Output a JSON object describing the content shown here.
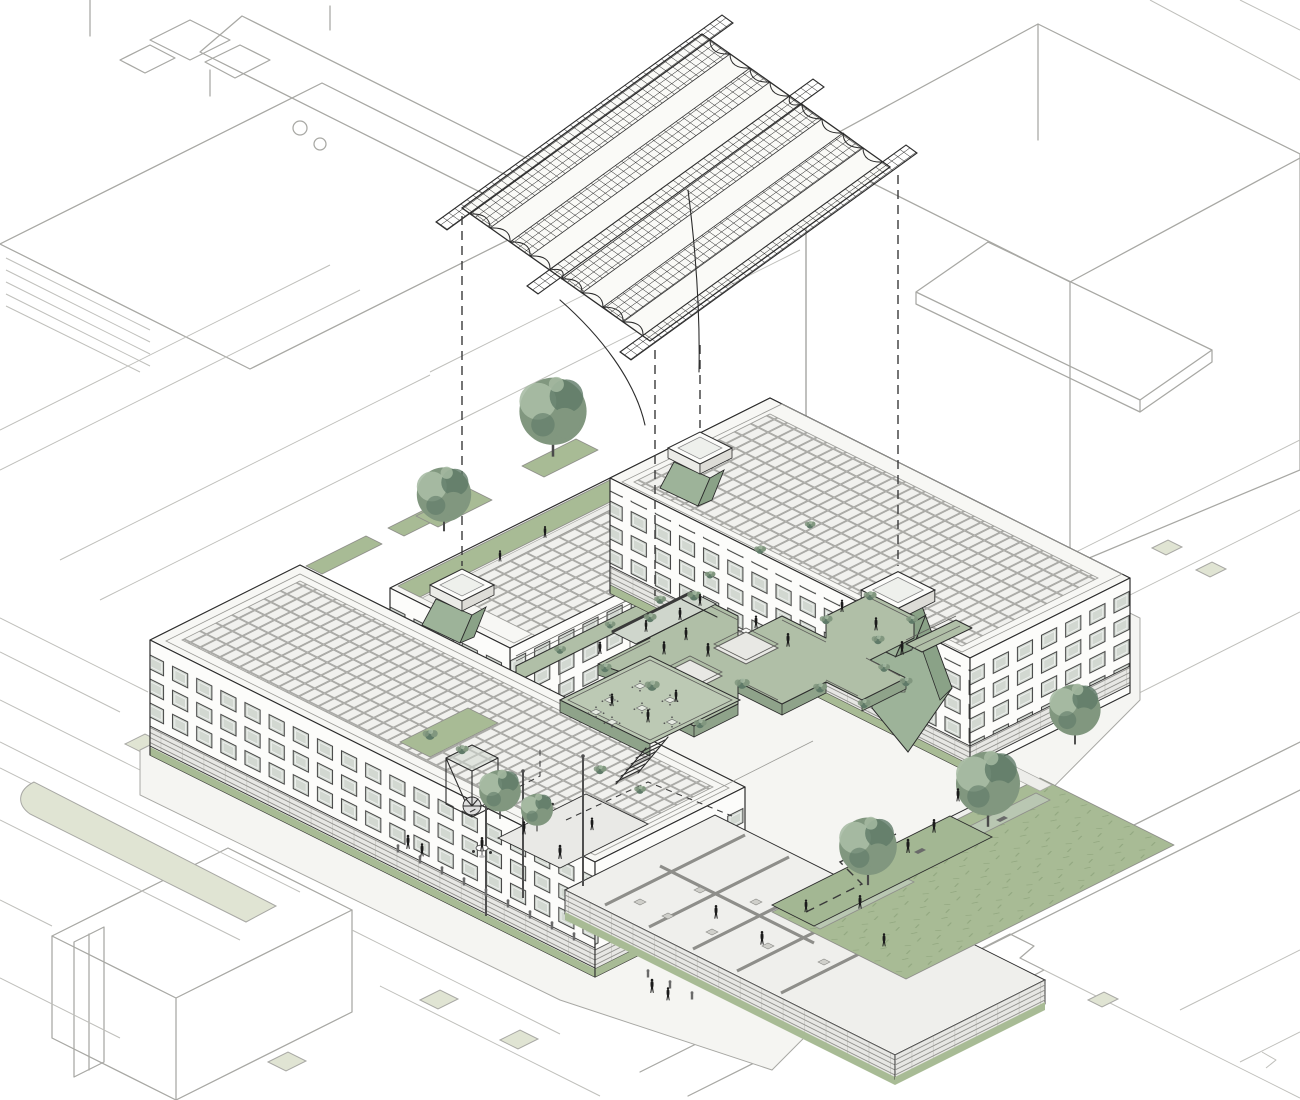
{
  "meta": {
    "title": "Axonometric architectural diagram — U-shaped courtyard building with exploded grid-shell roof canopy",
    "type": "architectural-axonometric-drawing",
    "width": 1300,
    "height": 1100
  },
  "colors": {
    "paper": "#ffffff",
    "ground": "#f5f5f2",
    "context_line": "#a8a8a4",
    "context_line_soft": "#bfbfbb",
    "ink": "#2c2c2c",
    "ink_soft": "#8f8f8b",
    "dash": "#3a3a3a",
    "facade": "#fcfcfa",
    "facade_shade": "#ebebe7",
    "facade_dark": "#dddcd7",
    "roof_white": "#f7f7f4",
    "parapet_line": "#9a9a96",
    "glass": "#d2d8d1",
    "frame": "#3f3f3f",
    "solar_bg": "#f1f1ee",
    "solar_line": "#9d9d99",
    "lattice_line": "#1f1f1f",
    "canopy_panel": "#fafaf7",
    "deck_green": "#b0bfa7",
    "deck_green_light": "#bcc9b4",
    "deck_fascia": "#8fa38a",
    "walkway_green": "#9db399",
    "funnel_green": "#8aa287",
    "lawn_green": "#a8bb95",
    "grass_mark": "#8aa078",
    "pale_green": "#e0e4d3",
    "planter_green": "#b9c7b2",
    "leaf_dark": "#5f7a68",
    "leaf_mid": "#81977f",
    "leaf_light": "#a9bda5",
    "trunk": "#4a4a4a",
    "figure": "#1b1b1b",
    "cutwall": "#8e8e8a",
    "louver_bg": "#e7e7e4",
    "louver_line": "#90908c",
    "furniture": "#cfcfca",
    "rail": "#5f5f5c"
  },
  "scene": {
    "description": "Isometric site drawing: a four-storey U-shaped building around a planted courtyard, with an exploded wavy lattice roof canopy hovering above, dashed projection lines, photovoltaic roofs, three rooflight towers with green light funnels, an elevated sage-green courtyard deck with stairs and cafe tables, a cutaway furnished ground floor, street context in light grey line work, lawns, trees and many human figures.",
    "canopy": {
      "label": "exploded grid-shell roof canopy",
      "modules": 8,
      "edge_beams": 3,
      "projection_lines": 4
    },
    "building": {
      "label": "U-shaped block around courtyard",
      "wings": [
        {
          "id": "west-wing",
          "floors": 4
        },
        {
          "id": "north-wing",
          "floors": 4
        },
        {
          "id": "east-wing",
          "floors": 4
        }
      ],
      "skylight_towers": 3,
      "roof_finish": "photovoltaic panel array"
    },
    "courtyard": {
      "label": "elevated planted deck",
      "stair_flights": 3,
      "cafe_tables": 7,
      "round_tables": 2,
      "voids": 2
    },
    "podium": {
      "label": "ground-floor cutaway interiors",
      "rooms": 8,
      "bollards": 12,
      "pergola_posts": 3
    },
    "landscape": {
      "trees": 7,
      "shrub_clusters": 24,
      "lawns": 1,
      "street_medians": 2,
      "ramps": 1,
      "benches": 2
    },
    "figures": {
      "count": 33
    }
  }
}
